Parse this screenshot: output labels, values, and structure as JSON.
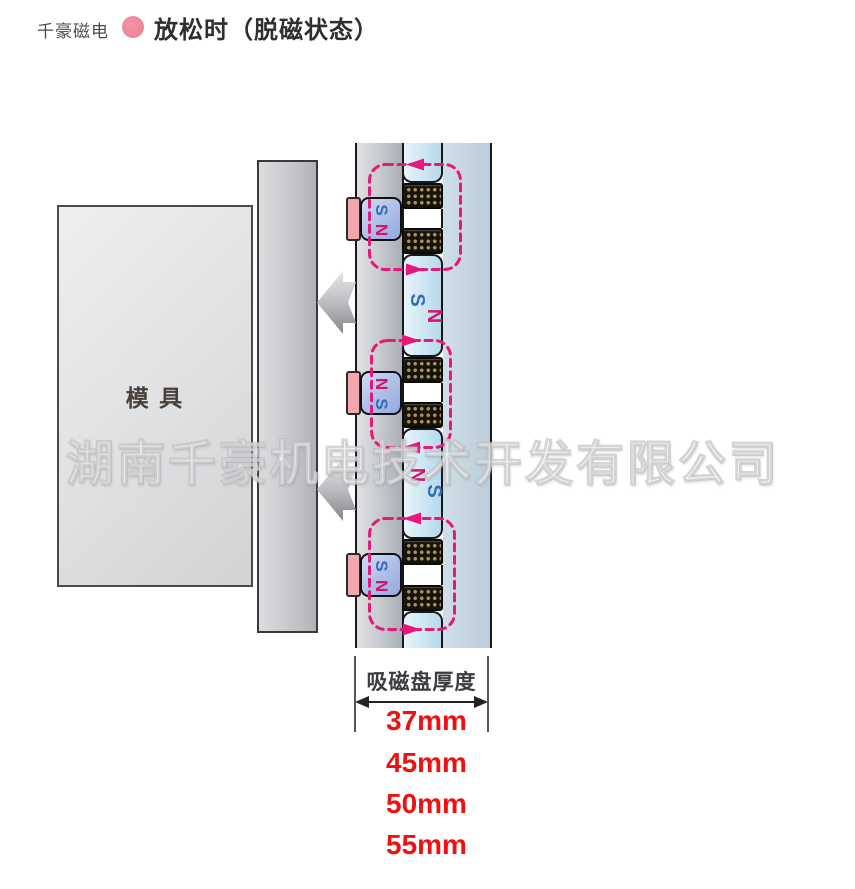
{
  "header": {
    "brand": "千豪磁电",
    "title": "放松时（脱磁状态）"
  },
  "watermark": "湖南千豪机电技术开发有限公司",
  "diagram": {
    "mold_label": "模  具",
    "magnets": [
      {
        "top": "S",
        "bottom": "N"
      },
      {
        "top": "N",
        "bottom": "S"
      },
      {
        "top": "S",
        "bottom": "N"
      }
    ],
    "pole_sections": [
      {
        "first": "S",
        "second": "N"
      },
      {
        "first": "N",
        "second": "S"
      }
    ]
  },
  "dimension": {
    "label": "吸磁盘厚度",
    "values": [
      "37mm",
      "45mm",
      "50mm",
      "55mm"
    ]
  },
  "colors": {
    "flux_pink": "#e6187c",
    "n_pole": "#d4156d",
    "s_pole": "#2f6fba",
    "value_red": "#ee1111",
    "brand_dot_pink": "#e87f92"
  }
}
